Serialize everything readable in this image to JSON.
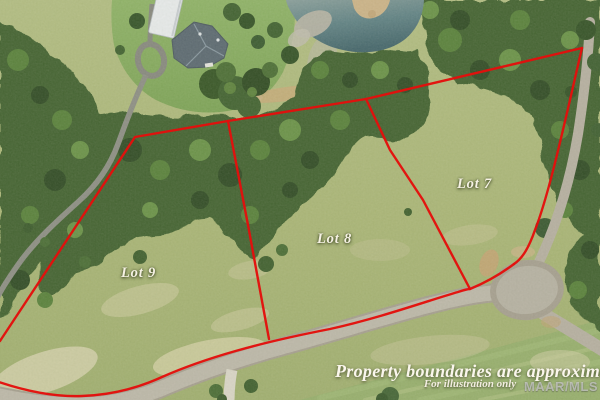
{
  "overlay": {
    "lot_labels": [
      {
        "id": "lot-7",
        "label": "Lot 7"
      },
      {
        "id": "lot-8",
        "label": "Lot 8"
      },
      {
        "id": "lot-9",
        "label": "Lot 9"
      }
    ],
    "disclaimer": {
      "primary": "Property boundaries are approximate",
      "secondary": "For illustration only"
    },
    "watermark": "MAAR/MLS"
  },
  "colors": {
    "boundary-red": "#e30f0c",
    "label-ivory": "#f6f2e4",
    "water-teal": "#4f7378",
    "meadow-green": "#adb877",
    "forest-green": "#3c5d2c",
    "road-gray": "#b6b0a2"
  }
}
